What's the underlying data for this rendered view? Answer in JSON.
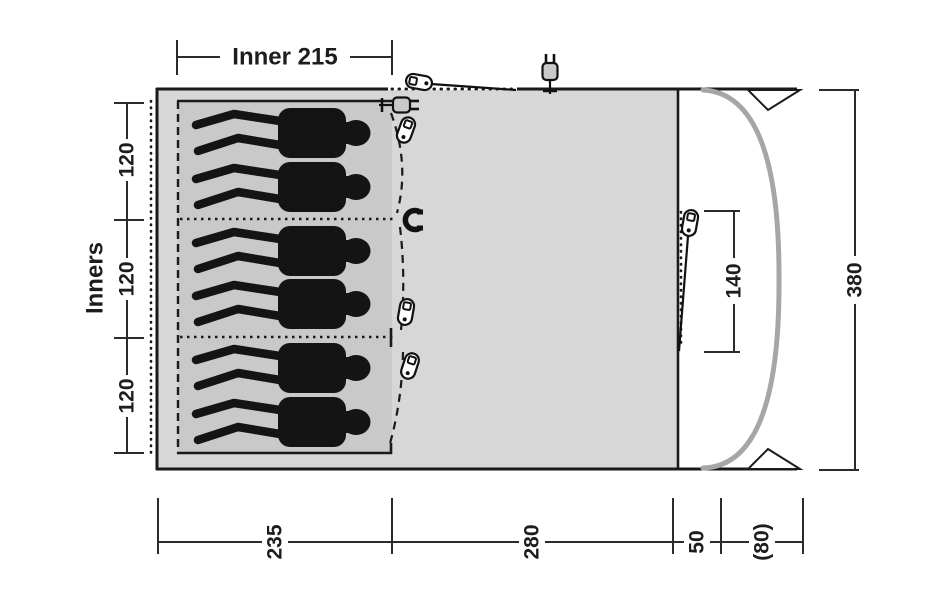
{
  "figure": {
    "type": "tent-floorplan-top-view",
    "labels": {
      "inner_width": "Inner 215",
      "inners": "Inners",
      "left_dims": [
        "120",
        "120",
        "120"
      ],
      "door_width": "140",
      "depth_total": "380",
      "bottom_dims": [
        "235",
        "280",
        "50",
        "(80)"
      ]
    },
    "colors": {
      "living_area": "#d7d7d7",
      "inner_area": "#c9c9c9",
      "outline": "#1a1a1a",
      "silhouette": "#141414",
      "canopy_pole": "#a6a6a6",
      "dimension_lines": "#2b2b2b"
    },
    "icons": [
      "toggle-icon",
      "magnet-icon",
      "power-plug-icon",
      "guyline-triangle"
    ],
    "sleeper_count": 6,
    "compartment_count": 3
  }
}
